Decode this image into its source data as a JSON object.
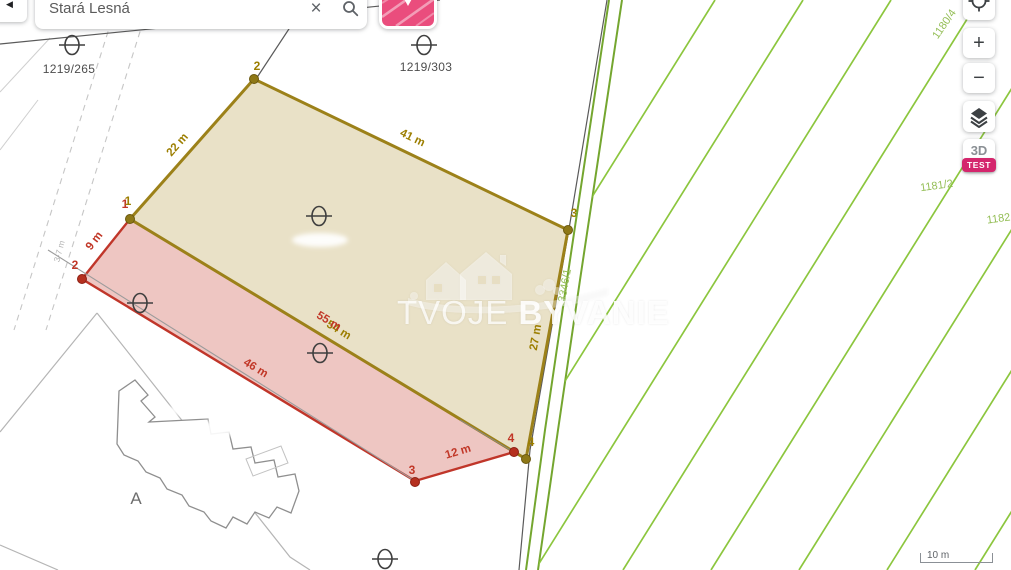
{
  "chrome": {
    "back": {
      "icon": "◀"
    },
    "search": {
      "value": "Stará Lesná",
      "clear_icon": "×"
    },
    "zoom_in": "+",
    "zoom_out": "−",
    "threed": "3D",
    "test_badge": "TEST",
    "scale": "10 m"
  },
  "watermark": {
    "light": "TVOJE",
    "bold": "BYVANIE"
  },
  "labels": {
    "p1219_265": "1219/265",
    "p1219_303": "1219/303",
    "p1180_4": "1180/4",
    "p1181_2": "1181/2",
    "p1182": "1182",
    "p3346_1": "3346/1",
    "road_width": "3-7 m",
    "letter_a": "A"
  },
  "tan_parcel": {
    "v1": "1",
    "v2": "2",
    "v3": "3",
    "v4": "4",
    "e12": "22 m",
    "e23": "41 m",
    "e34": "27 m",
    "e41": "54 m"
  },
  "pink_parcel": {
    "v1": "1",
    "v2": "2",
    "v3": "3",
    "v4": "4",
    "e12": "9 m",
    "e23": "46 m",
    "e34": "12 m",
    "e41": "55 m"
  },
  "colors": {
    "tan_fill": "#e8dfc3",
    "tan_stroke": "#9c8119",
    "pink_fill": "#edc4bf",
    "pink_stroke": "#c0362a",
    "green_boundary": "#74a62f",
    "green_hatch": "#8cc63e",
    "green_label": "#94be56",
    "accent_pink": "#ea4d7d"
  }
}
